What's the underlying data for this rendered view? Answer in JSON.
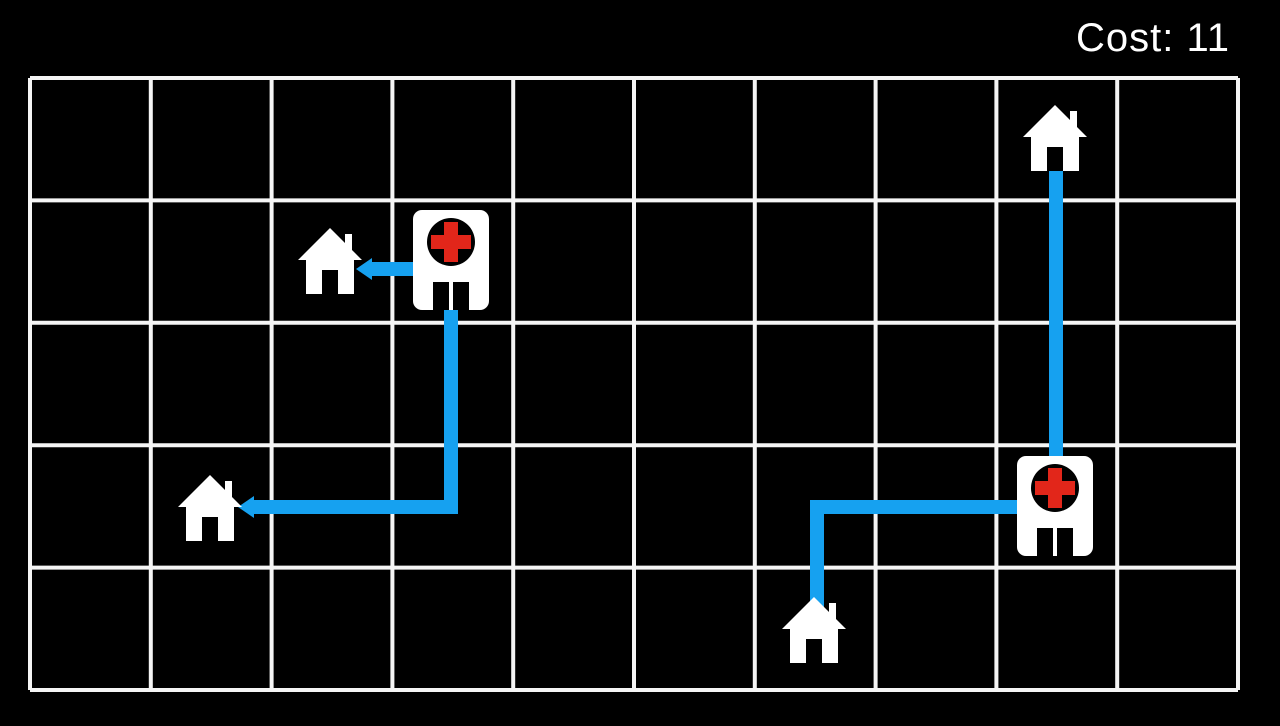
{
  "hud": {
    "cost_label": "Cost: 11",
    "cost_value": 11
  },
  "colors": {
    "background": "#000000",
    "grid_line": "#f5f5f5",
    "path": "#16a1f0",
    "building": "#ffffff",
    "cross": "#e2261a",
    "door": "#000000"
  },
  "board": {
    "grid": {
      "columns": 10,
      "rows": 5,
      "left": 30,
      "top": 78,
      "right": 1238,
      "bottom": 690,
      "line_width": 4
    },
    "entities": [
      {
        "id": "house-top-right",
        "type": "house",
        "col": 8,
        "row": 0,
        "cx": 1055,
        "cy": 138
      },
      {
        "id": "house-mid-left",
        "type": "house",
        "col": 2,
        "row": 1,
        "cx": 330,
        "cy": 261
      },
      {
        "id": "hospital-left",
        "type": "hospital",
        "col": 3,
        "row": 1,
        "cx": 451,
        "cy": 260
      },
      {
        "id": "house-lower-left",
        "type": "house",
        "col": 1,
        "row": 3,
        "cx": 210,
        "cy": 508
      },
      {
        "id": "hospital-right",
        "type": "hospital",
        "col": 8,
        "row": 3,
        "cx": 1055,
        "cy": 506
      },
      {
        "id": "house-bottom-mid",
        "type": "house",
        "col": 6,
        "row": 4,
        "cx": 814,
        "cy": 630
      }
    ],
    "paths": [
      {
        "id": "path-hospital-left-to-house-mid-left",
        "points": [
          [
            413,
            269
          ],
          [
            372,
            269
          ]
        ],
        "arrow": true
      },
      {
        "id": "path-hospital-left-to-house-lower-left",
        "points": [
          [
            451,
            306
          ],
          [
            451,
            507
          ],
          [
            254,
            507
          ]
        ],
        "arrow": true
      },
      {
        "id": "path-house-top-right-to-hospital-right",
        "points": [
          [
            1056,
            171
          ],
          [
            1056,
            456
          ]
        ],
        "arrow": false
      },
      {
        "id": "path-house-bottom-mid-to-hospital-right",
        "points": [
          [
            1017,
            507
          ],
          [
            817,
            507
          ],
          [
            817,
            619
          ]
        ],
        "arrow": false
      }
    ],
    "path_stroke_width": 14,
    "arrow": {
      "length": 16,
      "half_width": 11
    }
  }
}
